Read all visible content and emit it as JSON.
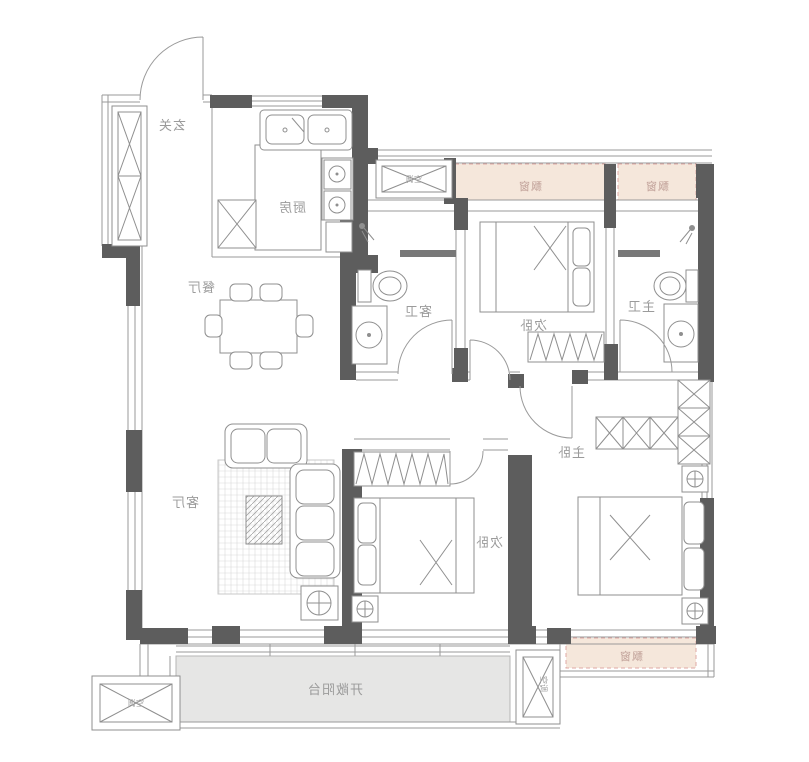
{
  "floor_plan": {
    "rooms": {
      "entry": "玄关",
      "kitchen": "厨房",
      "dining": "餐厅",
      "living": "客厅",
      "guest_bath": "客卫",
      "bedroom_top": "次卧",
      "master_bath": "主卫",
      "master_bedroom": "主卧",
      "bedroom_bottom": "次卧",
      "balcony": "开敞阳台"
    },
    "bay_window_label": "飘窗",
    "ac_label": "空调",
    "labels_mirrored": true,
    "colors": {
      "wall": "#5d5d5d",
      "line": "#9a9a9a",
      "bay_fill": "#f5e7db",
      "bay_stroke": "#dfa8a4",
      "bay_text": "#c0a098",
      "balcony_fill": "#e6e6e5",
      "label_text": "#9b9b9b",
      "background": "#ffffff"
    }
  }
}
